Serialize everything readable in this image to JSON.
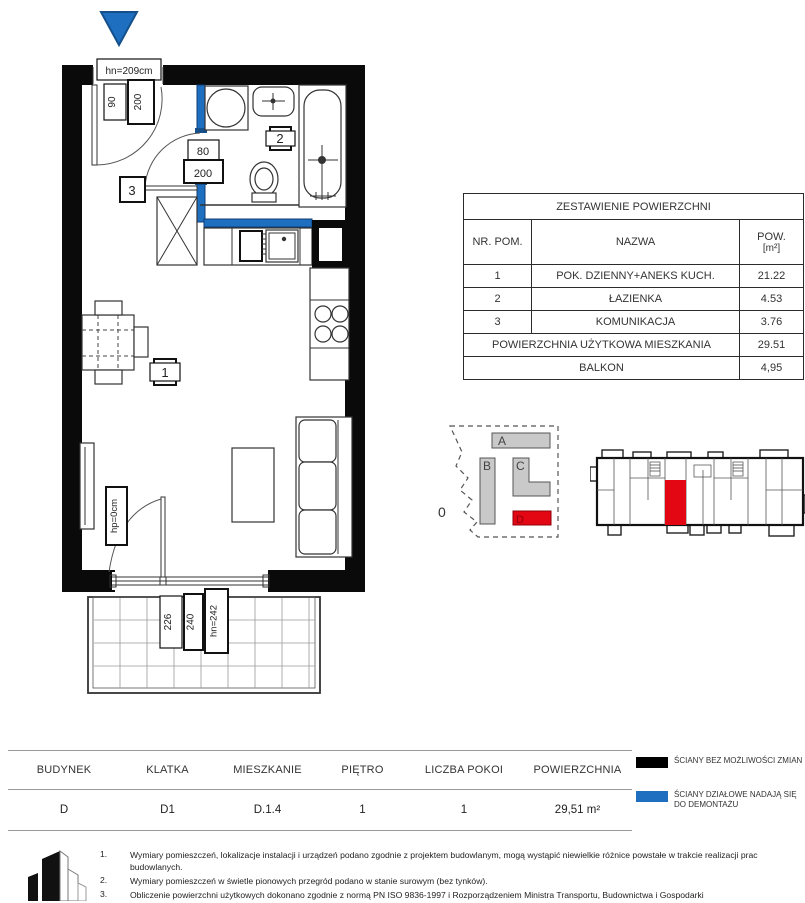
{
  "plan": {
    "labels": {
      "entrance_height": "hn=209cm",
      "entrance_door_width": "90",
      "entrance_door_height": "200",
      "bath_door_width": "80",
      "bath_door_height": "200",
      "room1": "1",
      "room2": "2",
      "room3": "3",
      "window_sill": "hp=0cm",
      "balcony_door_width": "226",
      "balcony_door_height": "240",
      "balcony_door_lintel": "hn=242"
    },
    "colors": {
      "wall": "#0a0a0a",
      "partition_blue": "#1e6fc0",
      "entry_arrow": "#1e6fc0"
    }
  },
  "area_table": {
    "title": "ZESTAWIENIE POWIERZCHNI",
    "col_nr": "NR. POM.",
    "col_name": "NAZWA",
    "col_pow_line1": "POW.",
    "col_pow_line2": "[m²]",
    "rows": [
      {
        "nr": "1",
        "name": "POK. DZIENNY+ANEKS KUCH.",
        "pow": "21.22"
      },
      {
        "nr": "2",
        "name": "ŁAZIENKA",
        "pow": "4.53"
      },
      {
        "nr": "3",
        "name": "KOMUNIKACJA",
        "pow": "3.76"
      }
    ],
    "total_label": "POWIERZCHNIA UŻYTKOWA MIESZKANIA",
    "total_value": "29.51",
    "balcony_label": "BALKON",
    "balcony_value": "4,95"
  },
  "site_plan": {
    "level": "0",
    "block_a": "A",
    "block_b": "B",
    "block_c": "C",
    "block_d": "D",
    "block_color": "#c9c9c9",
    "highlight_color": "#e30613"
  },
  "info_bar": {
    "columns": [
      {
        "label": "BUDYNEK",
        "value": "D"
      },
      {
        "label": "KLATKA",
        "value": "D1"
      },
      {
        "label": "MIESZKANIE",
        "value": "D.1.4"
      },
      {
        "label": "PIĘTRO",
        "value": "1"
      },
      {
        "label": "LICZBA POKOI",
        "value": "1"
      },
      {
        "label": "POWIERZCHNIA",
        "value": "29,51 m²"
      }
    ]
  },
  "legend": {
    "item1": {
      "color": "#000000",
      "text": "Ściany bez możliwości zmian"
    },
    "item2": {
      "color": "#1e6fc0",
      "text": "Ściany działowe nadają się do demontażu"
    }
  },
  "notes": [
    {
      "num": "1.",
      "text": "Wymiary pomieszczeń, lokalizacje instalacji i urządzeń podano zgodnie z projektem budowlanym, mogą wystąpić niewielkie różnice powstałe  w trakcie realizacji prac budowlanych."
    },
    {
      "num": "2.",
      "text": "Wymiary pomieszczeń w świetle pionowych przegród podano w stanie surowym (bez tynków)."
    },
    {
      "num": "3.",
      "text": "Obliczenie powierzchni użytkowych dokonano zgodnie z normą PN ISO 9836-1997 i Rozporządzeniem Ministra Transportu, Budownictwa i Gospodarki"
    }
  ]
}
